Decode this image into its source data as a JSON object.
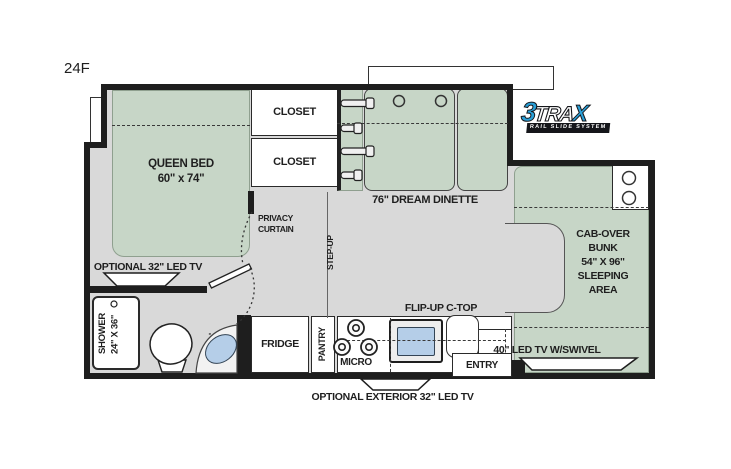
{
  "plan": {
    "model": "24F"
  },
  "colors": {
    "wall": "#1e1e1e",
    "floor": "#d9d9d9",
    "furniture_green": "#c7d6c7",
    "sink_blue": "#b5cee8",
    "logo_blue": "#2aa0d8",
    "text": "#1f1f1f"
  },
  "labels": {
    "queen_bed_line1": "QUEEN BED",
    "queen_bed_line2": "60\" x 74\"",
    "closet_top": "CLOSET",
    "closet_bottom": "CLOSET",
    "dinette": "76\" DREAM DINETTE",
    "privacy_line1": "PRIVACY",
    "privacy_line2": "CURTAIN",
    "step_up": "STEP-UP",
    "bedroom_tv": "OPTIONAL 32\" LED TV",
    "shower_line1": "SHOWER",
    "shower_line2": "24\" X 36\"",
    "fridge": "FRIDGE",
    "pantry": "PANTRY",
    "micro": "MICRO",
    "flip_up_ctop": "FLIP-UP C-TOP",
    "entry": "ENTRY",
    "cab_over": [
      "CAB-OVER",
      "BUNK",
      "54\" X 96\"",
      "SLEEPING",
      "AREA"
    ],
    "cab_tv": "40\" LED TV W/SWIVEL",
    "exterior_tv": "OPTIONAL EXTERIOR 32\" LED TV"
  },
  "logo": {
    "prefix": "3",
    "mid": "TRA",
    "suffix": "X",
    "tagline": "RAIL SLIDE SYSTEM"
  }
}
